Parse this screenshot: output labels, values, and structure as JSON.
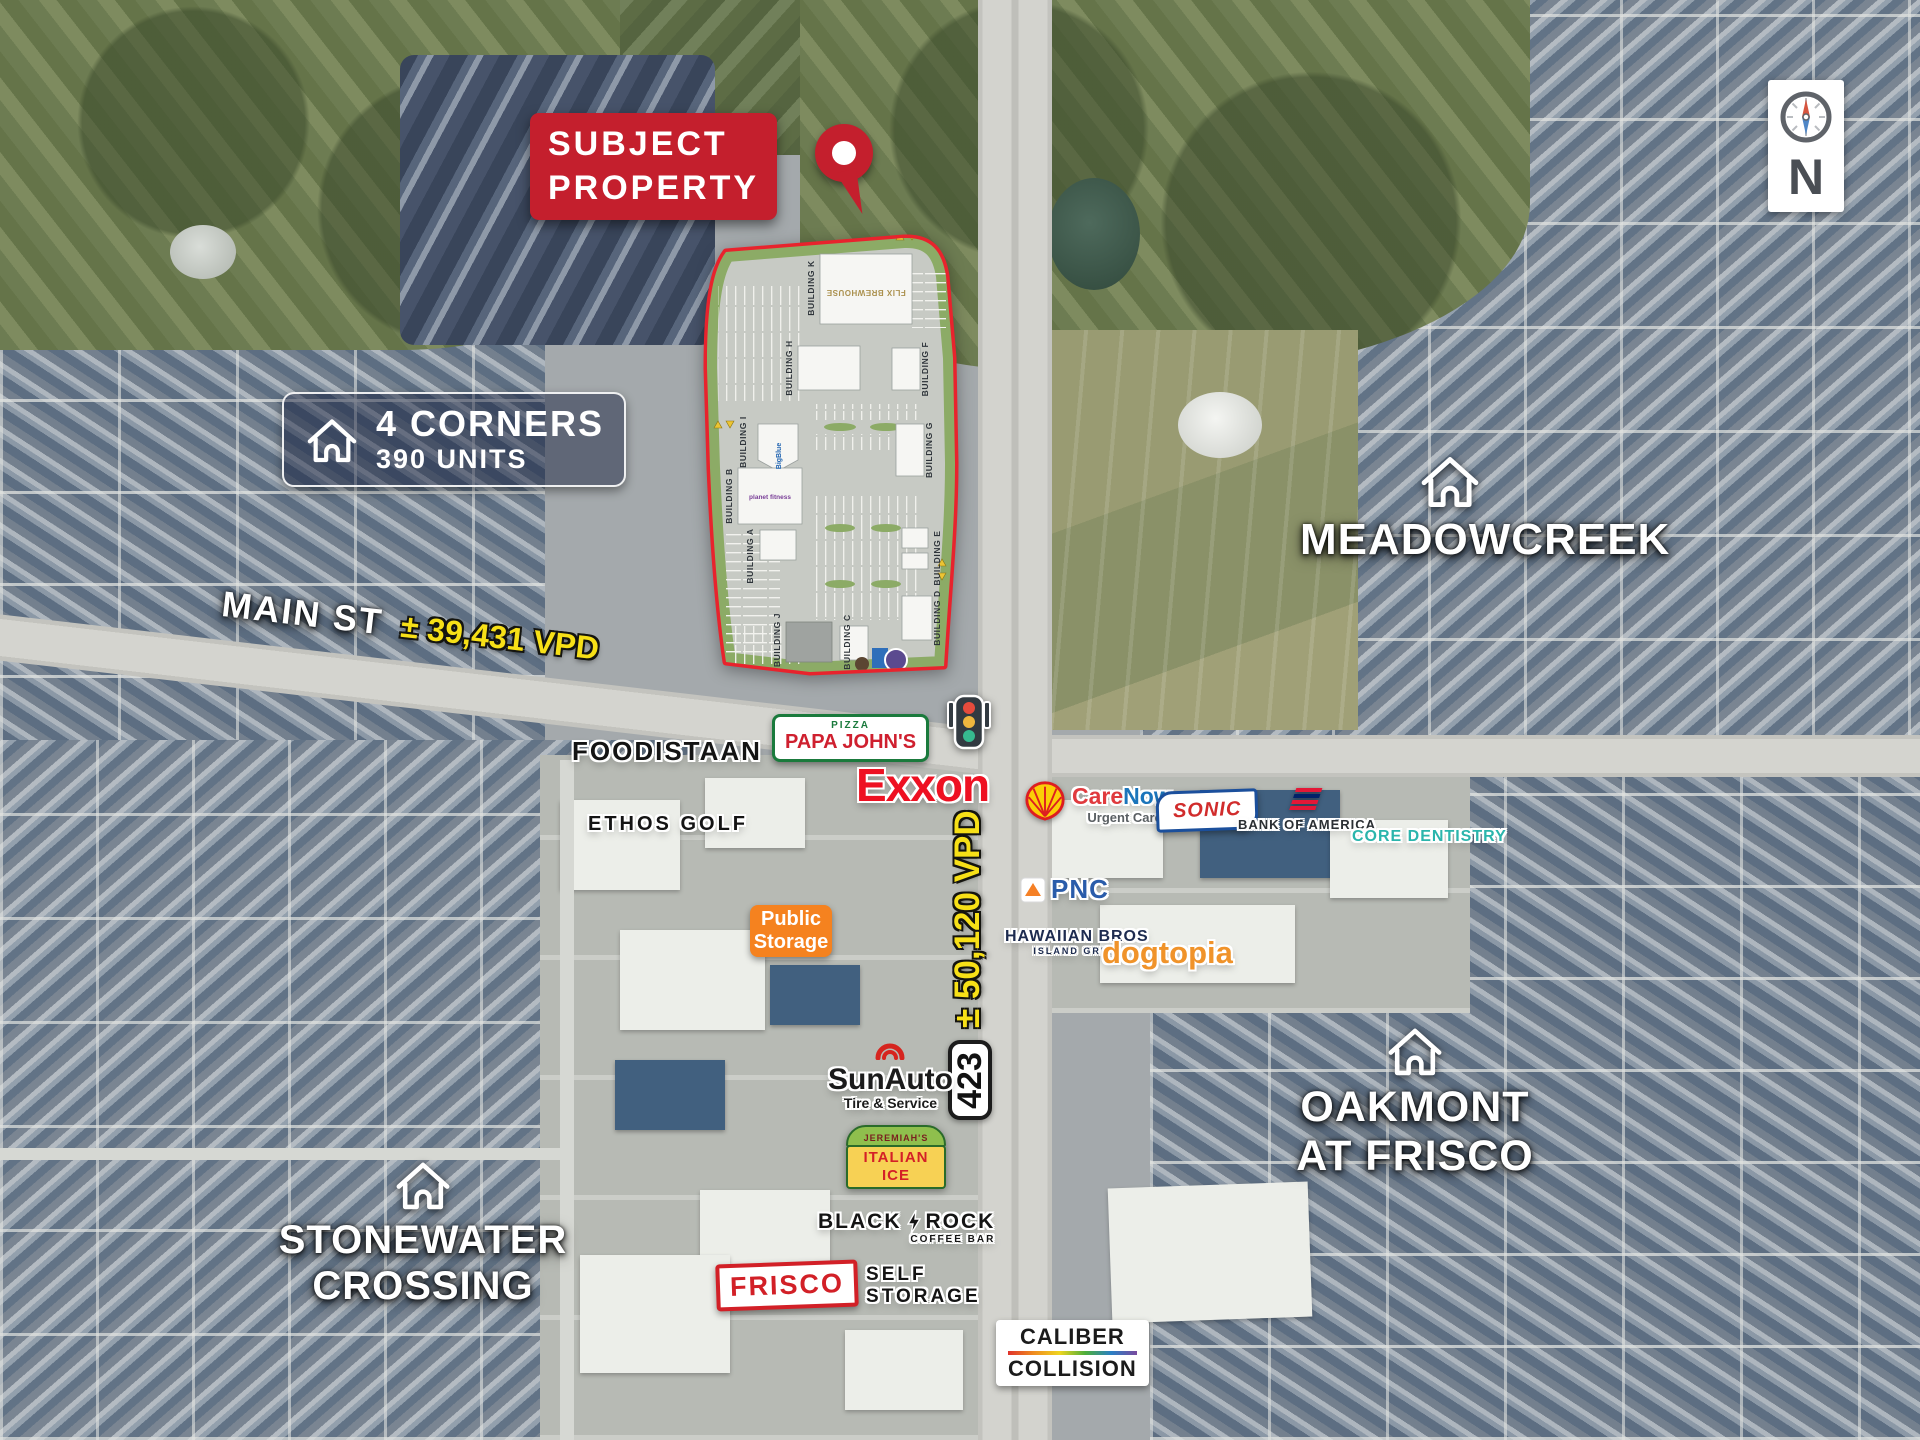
{
  "subject_banner": {
    "line1": "SUBJECT",
    "line2": "PROPERTY"
  },
  "four_corners": {
    "name": "4 CORNERS",
    "units": "390 UNITS"
  },
  "neighborhoods": {
    "meadowcreek": {
      "name": "MEADOWCREEK"
    },
    "oakmont": {
      "line1": "OAKMONT",
      "line2": "AT FRISCO"
    },
    "stonewater": {
      "line1": "STONEWATER",
      "line2": "CROSSING"
    }
  },
  "roads": {
    "main_st_label": "MAIN ST",
    "main_st_vpd": "± 39,431 VPD",
    "hwy_vpd": "± 50,120 VPD",
    "hwy_shield": "423"
  },
  "compass_label": "N",
  "site_plan": {
    "buildings": [
      "BUILDING A",
      "BUILDING B",
      "BUILDING C",
      "BUILDING D",
      "BUILDING E",
      "BUILDING F",
      "BUILDING G",
      "BUILDING H",
      "BUILDING I",
      "BUILDING J",
      "BUILDING K"
    ],
    "tenants": [
      "FLIX BREWHOUSE",
      "BigBlue",
      "planet fitness"
    ]
  },
  "businesses": {
    "foodistaan": "FOODISTAAN",
    "ethos_golf": "ETHOS GOLF",
    "papa_johns_top": "PIZZA",
    "papa_johns": "PAPA JOHN'S",
    "exxon": "Exxon",
    "public_storage_1": "Public",
    "public_storage_2": "Storage",
    "carenow_1": "Care",
    "carenow_2": "Now.",
    "carenow_sub": "Urgent Care",
    "sonic": "SONIC",
    "bank_of_america": "BANK OF AMERICA",
    "core_dentistry": "CORE DENTISTRY",
    "pnc": "PNC",
    "hawaiian_1": "HAWAIIAN BROS",
    "hawaiian_2": "ISLAND GRILL",
    "dogtopia": "dogtopia",
    "sunauto": "SunAuto",
    "sunauto_sub": "Tire & Service",
    "jeremiahs_top": "JEREMIAH'S",
    "jeremiahs": "ITALIAN ICE",
    "blackrock_1": "BLACK",
    "blackrock_2": "ROCK",
    "blackrock_sub": "COFFEE BAR",
    "frisco": "FRISCO",
    "frisco_sub_1": "SELF",
    "frisco_sub_2": "STORAGE",
    "caliber_1": "CALIBER",
    "caliber_2": "COLLISION"
  },
  "colors": {
    "accent_red": "#c41f2d",
    "vpd_yellow": "#f7e017",
    "site_outline_red": "#e8232d",
    "public_storage_orange": "#f5821f"
  }
}
